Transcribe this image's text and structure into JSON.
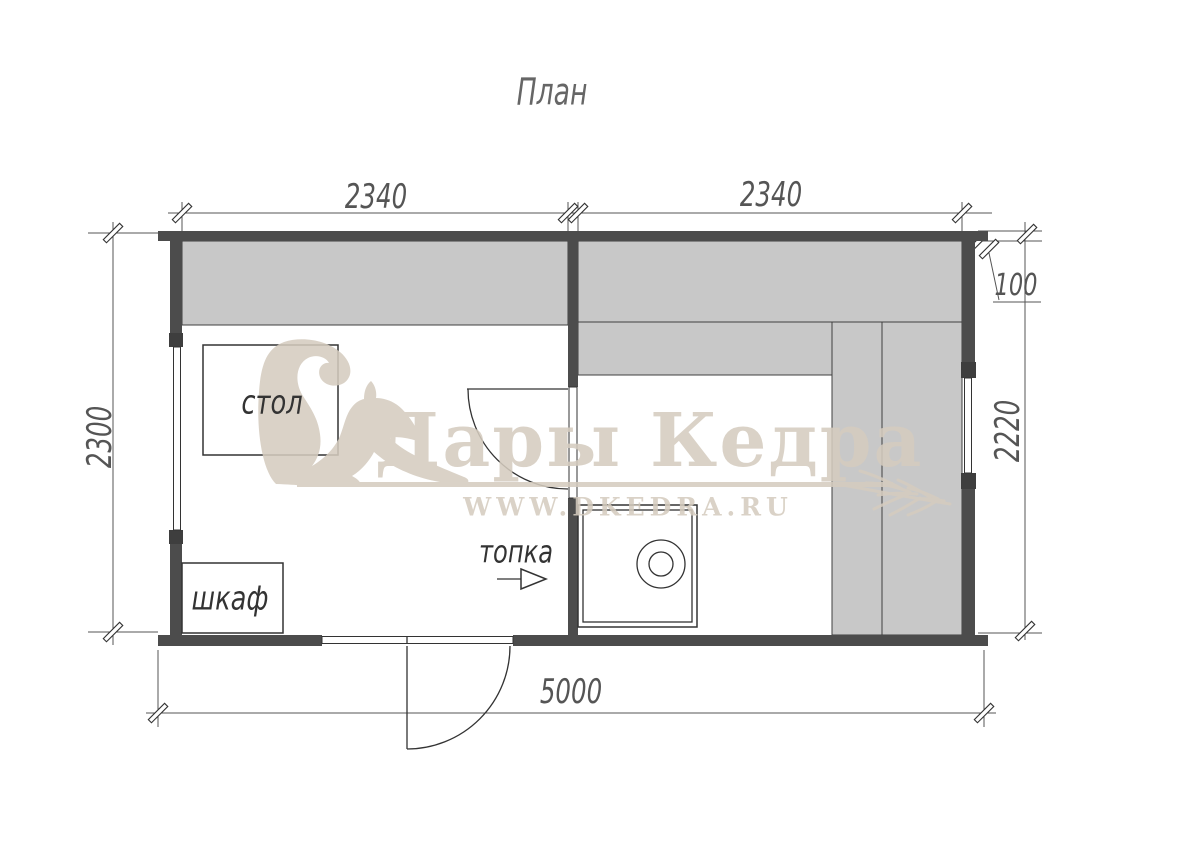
{
  "title": "План",
  "dimensions": {
    "room1_width": "2340",
    "room2_width": "2340",
    "wall_thickness": "100",
    "overall_depth": "2300",
    "sauna_depth": "2220",
    "overall_width": "5000"
  },
  "labels": {
    "table": "стол",
    "cabinet": "шкаф",
    "firebox": "топка"
  },
  "watermark": {
    "brand": "Дары Кедра",
    "url": "WWW.DKEDRA.RU"
  },
  "colors": {
    "wall": "#4c4c4c",
    "bench": "#c8c8c8",
    "line": "#333333",
    "dim": "#555555",
    "watermark": "#d5ccbf"
  }
}
